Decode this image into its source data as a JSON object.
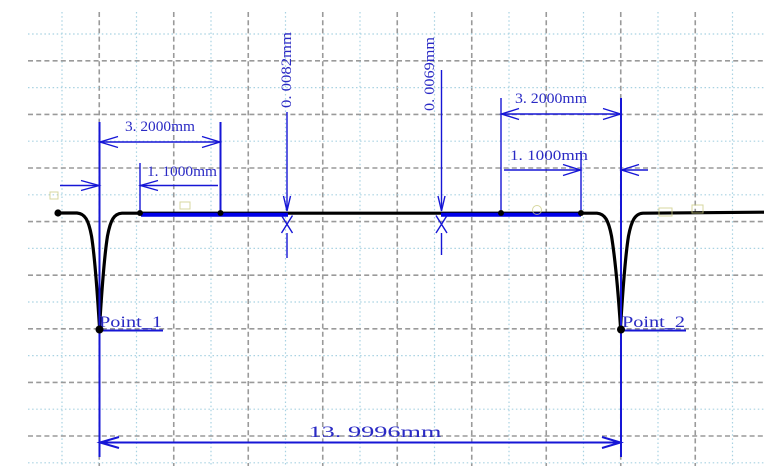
{
  "colors": {
    "background": "#ffffff",
    "dimension_blue": "#1616d6",
    "text_blue": "#2a2ac4",
    "zone_blue": "#0000e8",
    "profile_black": "#000000",
    "grid_major_gray": "#9a9a9a",
    "grid_minor_blue": "#a8d2e2",
    "marker_olive": "#c9c97f"
  },
  "chart_data": {
    "type": "line",
    "title": "",
    "units": "mm",
    "description": "Surface profile / step-height measurement trace: flat baseline with two deep V-shaped grooves (Point_1, Point_2), blue evaluation zones and CAD-style dimension callouts",
    "grid": {
      "style": "alternating gray dashed major and light-blue dotted minor lines",
      "on": true
    },
    "profile": {
      "baseline_y_px": 213,
      "groove_depth_px": 117,
      "px_per_mm": 37.2,
      "groove_centers_px": [
        100,
        621
      ]
    },
    "points": [
      {
        "label": "Point_1",
        "x_mm": 0
      },
      {
        "label": "Point_2",
        "x_mm": 13.9996
      }
    ],
    "measurements": [
      {
        "label": "3. 2000mm",
        "value_mm": 3.2,
        "side": "left",
        "orientation": "horizontal"
      },
      {
        "label": "1. 1000mm",
        "value_mm": 1.1,
        "side": "left",
        "orientation": "horizontal"
      },
      {
        "label": "0. 0082mm",
        "value_mm": 0.0082,
        "side": "left",
        "orientation": "vertical"
      },
      {
        "label": "0. 0069mm",
        "value_mm": 0.0069,
        "side": "right",
        "orientation": "vertical"
      },
      {
        "label": "3. 2000mm",
        "value_mm": 3.2,
        "side": "right",
        "orientation": "horizontal"
      },
      {
        "label": "1. 1000mm",
        "value_mm": 1.1,
        "side": "right",
        "orientation": "horizontal"
      },
      {
        "label": "13. 9996mm",
        "value_mm": 13.9996,
        "side": "bottom",
        "orientation": "horizontal",
        "span": "Point_1 to Point_2"
      }
    ]
  }
}
